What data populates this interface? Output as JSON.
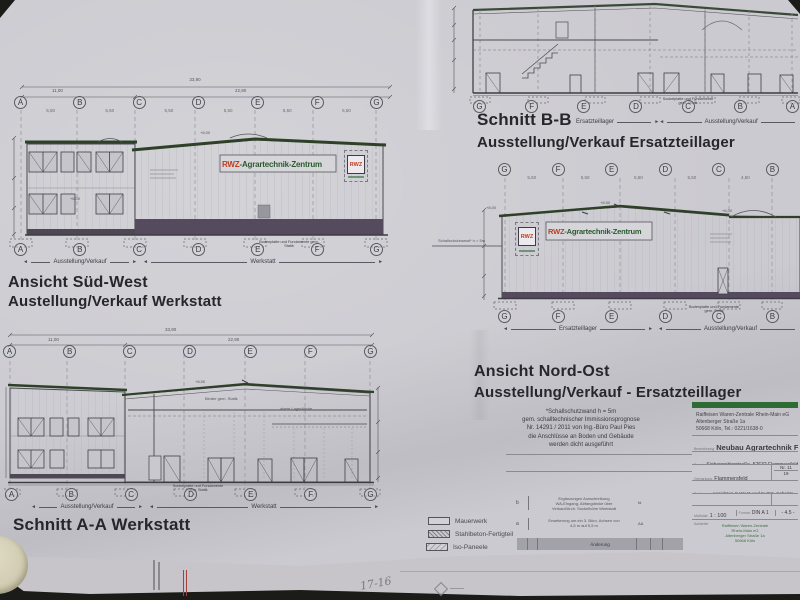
{
  "sheet": {
    "handwritten_note": "17-16"
  },
  "sued_west": {
    "title1": "Ansicht Süd-West",
    "title2": "Austellung/Verkauf Werkstatt",
    "grid": [
      "A",
      "B",
      "C",
      "D",
      "E",
      "F",
      "G"
    ],
    "gap_dims": [
      "5,50",
      "5,50",
      "5,50",
      "5,50",
      "5,50",
      "5,50"
    ],
    "dim_total": "33,90",
    "dim_left": "11,00",
    "dim_right": "22,90",
    "label_left": "Ausstellung/Verkauf",
    "label_right": "Werkstatt",
    "sign_red": "RWZ",
    "sign_green": "-Agrartechnik-Zentrum",
    "badge": "RWZ",
    "level_peak": "+8,00",
    "level_eave": "+6,00",
    "foundation_note": "Bodenplatte und Fundamente gem. Statik"
  },
  "schnitt_bb": {
    "title1": "Schnitt B-B",
    "title2": "Ausstellung/Verkauf Ersatzteillager",
    "grid": [
      "G",
      "F",
      "E",
      "D",
      "C",
      "B",
      "A"
    ],
    "label_left": "Ersatzteillager",
    "label_right": "Ausstellung/Verkauf",
    "foundation_note": "Sockelplatte und Fundamente gem. Statik"
  },
  "nord_ost": {
    "title1": "Ansicht Nord-Ost",
    "title2": "Ausstellung/Verkauf - Ersatzteillager",
    "grid": [
      "G",
      "F",
      "E",
      "D",
      "C",
      "B"
    ],
    "gap_dims": [
      "5,50",
      "5,50",
      "5,50",
      "5,50",
      "4,50"
    ],
    "label_left": "Ersatzteillager",
    "label_right": "Ausstellung/Verkauf",
    "sign_red": "RWZ",
    "sign_green": "-Agrartechnik-Zentrum",
    "badge": "RWZ",
    "wall_note": "Schallschutzwand* h = 5m",
    "level_left": "+8,00",
    "level_ridge": "+8,50",
    "level_right": "+6,00",
    "foundation_note": "Bodenplatte und Fundamente gem. Statik"
  },
  "schnitt_aa": {
    "title": "Schnitt A-A Werkstatt",
    "grid": [
      "A",
      "B",
      "C",
      "D",
      "E",
      "F",
      "G"
    ],
    "dim_total": "33,90",
    "dim_left": "11,00",
    "dim_right": "22,90",
    "label_left": "Ausstellung/Verkauf",
    "label_right": "Werkstatt",
    "truss_note": "Binder gem. Statik",
    "mezz_note": "obere Lagerfläche",
    "level_ridge": "+8,50",
    "foundation_note": "Sockelplatte und Fundamente gem. Statik"
  },
  "sound_note": {
    "l1": "*Schallschutzwand h = 5m",
    "l2": "gem. schalltechnischer Immissionsprognose",
    "l3": "Nr. 14291 / 2011 von Ing.-Büro Paul Pies",
    "l4": "die Anschlüsse an Boden und Gebäude",
    "l5": "werden dicht ausgeführt"
  },
  "legend": {
    "items": [
      "Mauerwerk",
      "Stahlbeton-Fertigteil",
      "Iso-Paneele"
    ]
  },
  "revisions": {
    "row_b_index": "b",
    "row_b_text1": "Ergänzungen Ausschreibung",
    "row_b_text2": "WA-Eingang, Abfangdecke über",
    "row_b_text3": "Verkauf/Arch. Sockelhöhe Werkstatt",
    "row_b_by": "fd",
    "row_a_index": "a",
    "row_a_text1": "Erweiterung um ein 3. Büro, Achsen von",
    "row_a_text2": "4,5 m auf 5,5 m",
    "row_a_by": "AA",
    "header": "Änderung"
  },
  "title_block": {
    "company1": "Raiffeisen Waren-Zentrale Rhein-Main eG",
    "company2": "Altenberger Straße 1a",
    "company3": "50668 Köln, Tel.: 0221/1638-0",
    "project_label": "Bezeichnung",
    "project": "Neubau Agrartechnik Flammersfeld",
    "site_label": "Bauort",
    "site": "Siebengebirgstraße, 57632 Flammersfeld",
    "district_label": "Gemarkung",
    "district": "Flammersfeld",
    "flur_label": "Nr.",
    "flur1": "11",
    "flur2": "19",
    "drawing_label": "Zeichnung",
    "drawing": "Ansichten S-West und N-Ost, Schnitte",
    "phase_label": "Planungsart",
    "phase": "Ausschreibung",
    "scale_label": "Maßstab",
    "scale": "1 : 100",
    "format_label": "Format",
    "format": "DIN A 1",
    "plan_no": "- 4.5 -",
    "arch1": "Raiffeisen Waren-Zentrale",
    "arch2": "Rhein-Main eG",
    "arch3": "Altenberger Straße 1a",
    "arch4": "50668 Köln"
  }
}
